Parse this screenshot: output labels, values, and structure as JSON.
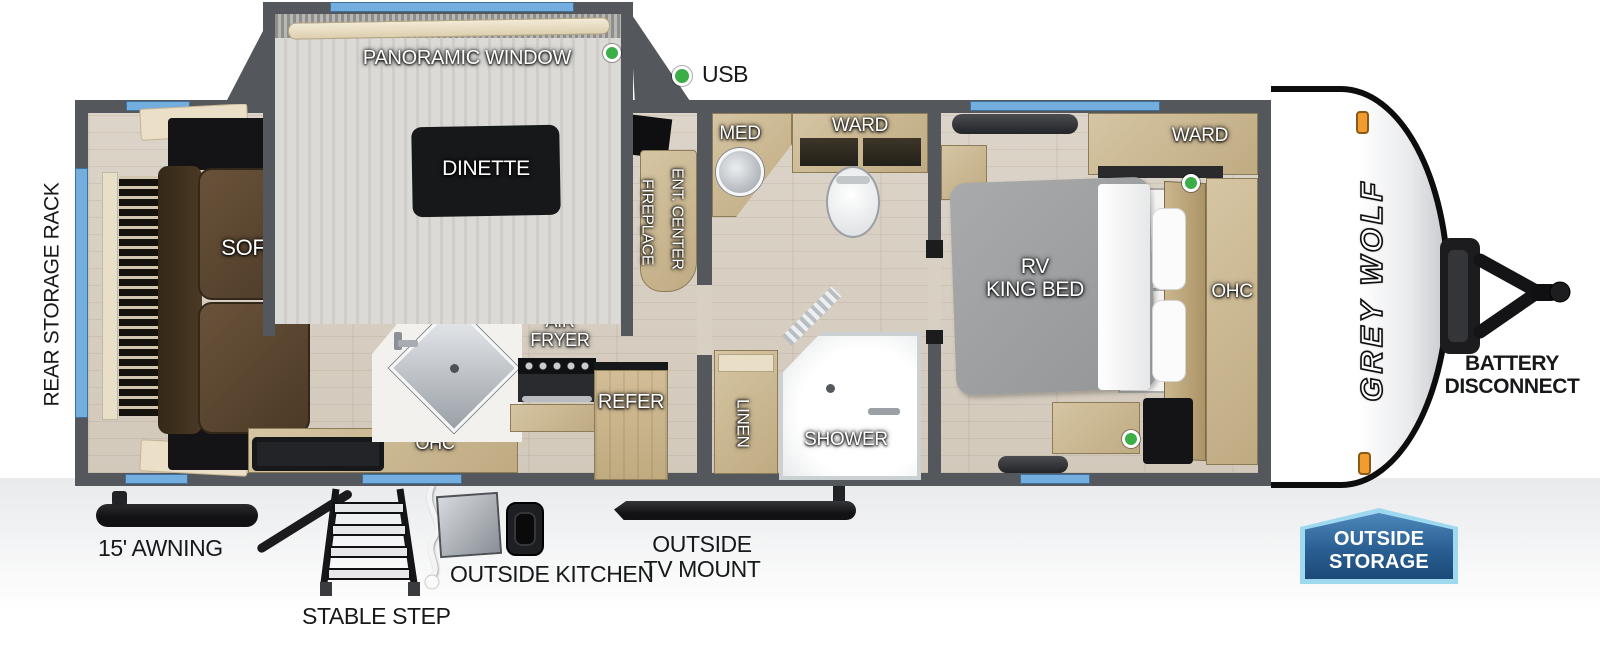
{
  "title": "Grey Wolf travel trailer floor plan",
  "brand": {
    "logo_vertical": "GREY WOLF"
  },
  "colors": {
    "wall": "#54585c",
    "floor_wood": "#d6cdc0",
    "cabinet_tan": "#c9b48c",
    "sofa_brown": "#5a4530",
    "bed_gray": "#9fa1a3",
    "window_blue": "#74aede",
    "usb_green": "#3cae47",
    "marker_orange": "#f29c2f",
    "badge_blue": "#1c4a78",
    "badge_border": "#9fd9f0"
  },
  "legend": {
    "usb": "USB"
  },
  "labels": {
    "rear_storage_rack": "REAR STORAGE RACK",
    "sofa": "SOFA",
    "panoramic_window": "PANORAMIC WINDOW",
    "dinette": "DINETTE",
    "fireplace": "FIREPLACE",
    "ent_center": "ENT. CENTER",
    "air_fryer": "AIR\nFRYER",
    "ohc_kitchen": "OHC",
    "refer": "REFER",
    "med": "MED",
    "ward_bath": "WARD",
    "linen": "LINEN",
    "shower": "SHOWER",
    "rv_king_bed": "RV\nKING BED",
    "ward_bedroom": "WARD",
    "ohc_bedroom": "OHC",
    "battery_disconnect": "BATTERY\nDISCONNECT",
    "awning": "15' AWNING",
    "stable_step": "STABLE STEP",
    "outside_kitchen": "OUTSIDE KITCHEN",
    "outside_tv_mount": "OUTSIDE\nTV MOUNT",
    "outside_storage": "OUTSIDE\nSTORAGE"
  }
}
